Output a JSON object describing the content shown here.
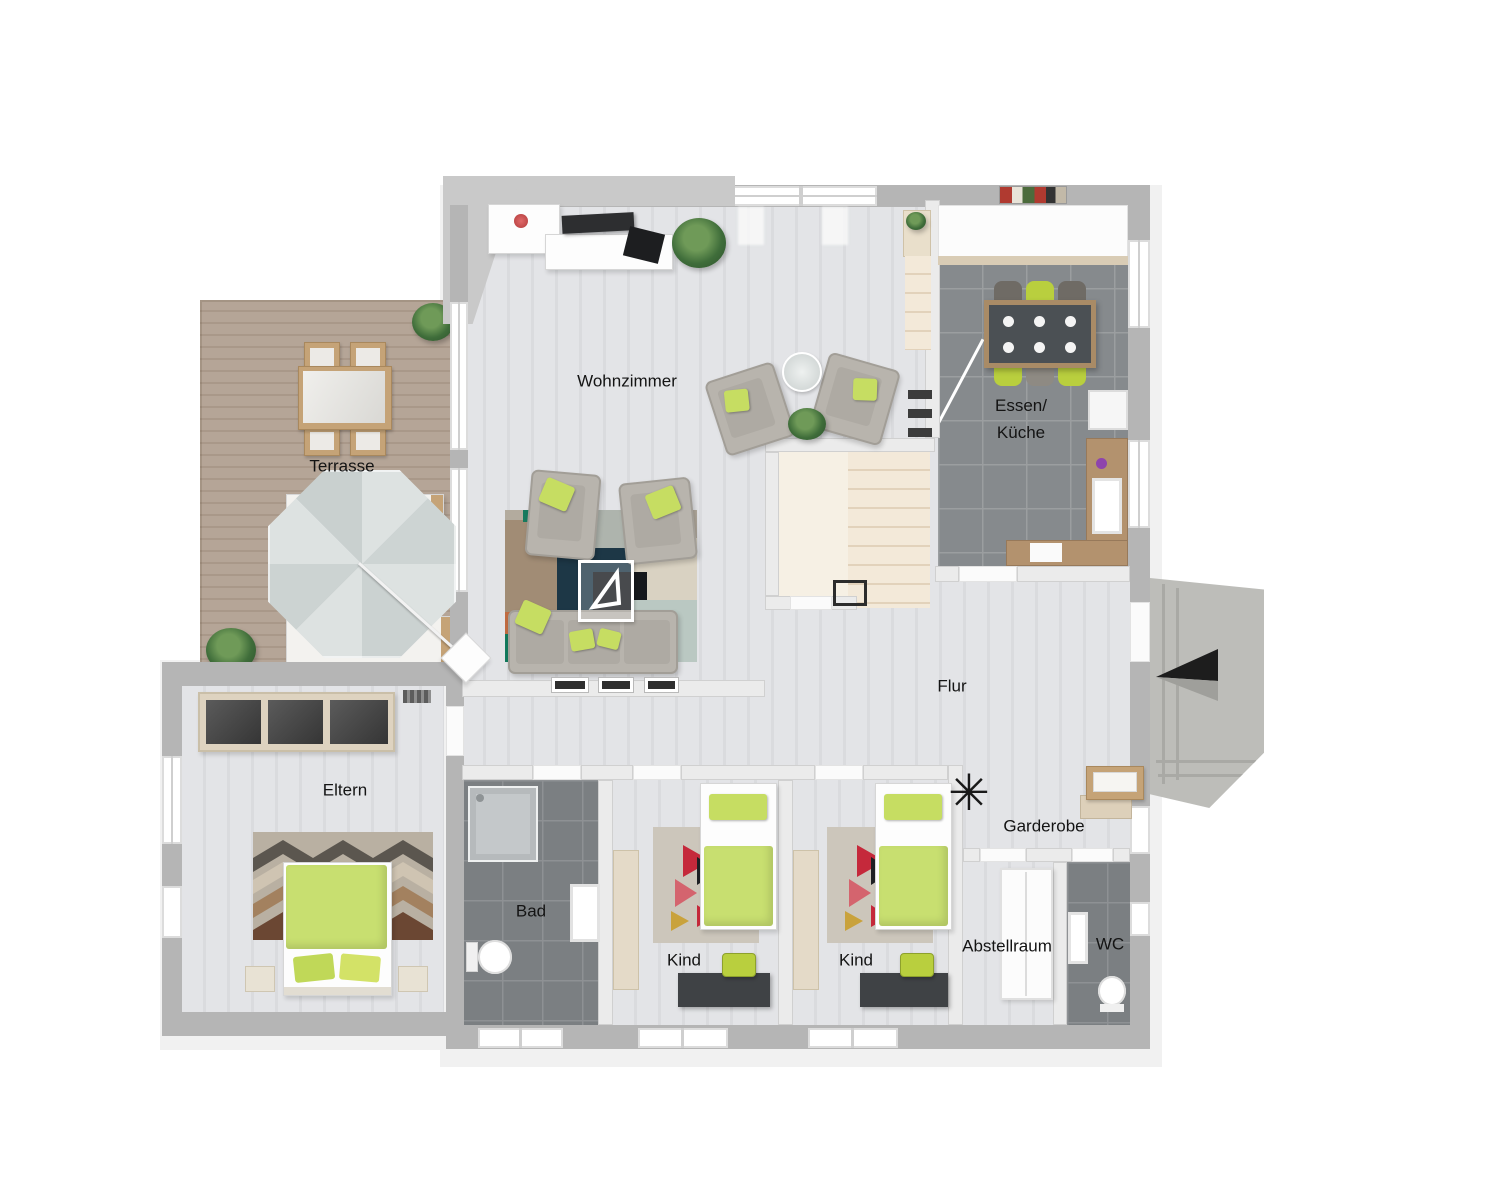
{
  "rooms": {
    "terrasse": {
      "label": "Terrasse"
    },
    "wohnzimmer": {
      "label": "Wohnzimmer"
    },
    "essen_kueche": {
      "label_line1": "Essen/",
      "label_line2": "Küche"
    },
    "flur": {
      "label": "Flur"
    },
    "eltern": {
      "label": "Eltern"
    },
    "bad": {
      "label": "Bad"
    },
    "kind_1": {
      "label": "Kind"
    },
    "kind_2": {
      "label": "Kind"
    },
    "garderobe": {
      "label": "Garderobe"
    },
    "abstellraum": {
      "label": "Abstellraum"
    },
    "wc": {
      "label": "WC"
    }
  },
  "icons": {
    "coat_rack": "✳",
    "entrance_arrow": "◄"
  },
  "palette": {
    "accent_green": "#c6dd62",
    "exterior_wall_gray": "#b5b5b5",
    "interior_wall": "#ebebeb",
    "wood_floor_light": "#e0e1e4",
    "kitchen_tile_gray": "#868a8d",
    "bath_tile_gray": "#7b7f82",
    "terrace_deck_wood": "#b0a092",
    "stair_cream": "#eee2cd",
    "sofa_gray": "#b8b4ad",
    "counter_wood": "#b3926e",
    "label_text": "#141414"
  }
}
